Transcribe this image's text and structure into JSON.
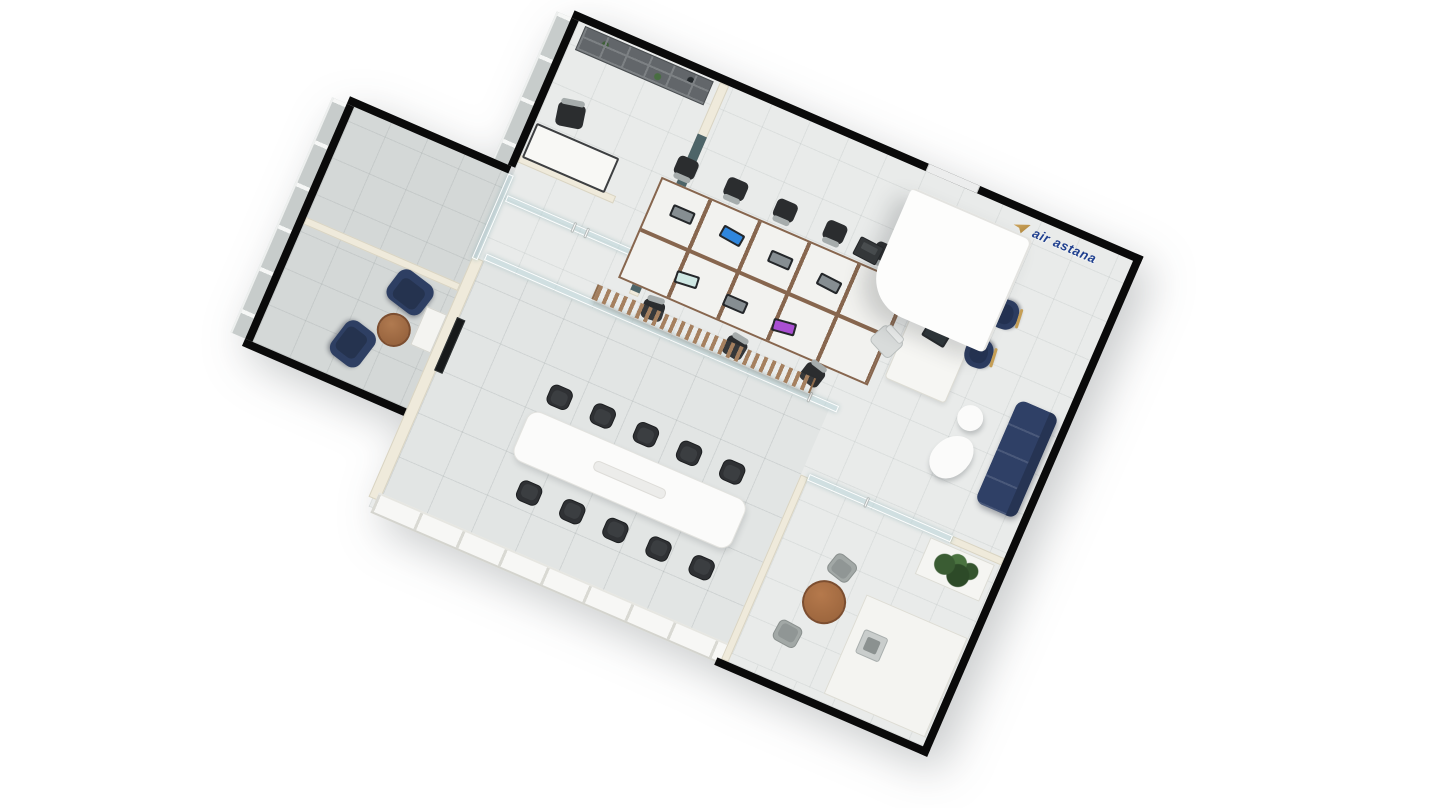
{
  "logo": {
    "text": "air astana",
    "icon": "air-astana-bird-icon",
    "text_color": "#20408f",
    "icon_gold": "#c59e55"
  },
  "palette": {
    "wall_black": "#0a0a0a",
    "wall_cream": "#efeadb",
    "floor_main": "#e9ebea",
    "floor_wing": "#d4d8d7",
    "floor_meeting": "#e2e5e4",
    "glass": "#bcd6d9",
    "glass_dark": "#41595f",
    "navy_upholstery": "#2e3f63",
    "wood_slats": "#a5805f",
    "walnut": "#a06a44",
    "gold": "#c59e55",
    "screen_blue": "#2f86dd",
    "screen_purple": "#a94fd2"
  },
  "rooms": [
    {
      "name": "executive-office"
    },
    {
      "name": "glass-meeting-booth"
    },
    {
      "name": "lounge"
    },
    {
      "name": "conference-room"
    },
    {
      "name": "open-workspace"
    },
    {
      "name": "reception"
    },
    {
      "name": "waiting-area"
    },
    {
      "name": "break-room"
    }
  ],
  "scene": {
    "floors": [
      {
        "t": "fla",
        "n": "floor-main",
        "x": 208,
        "y": 8,
        "w": 604,
        "h": 529
      },
      {
        "t": "flb",
        "n": "floor-left-wing",
        "x": 36,
        "y": 176,
        "w": 168,
        "h": 256
      },
      {
        "t": "flc",
        "n": "floor-conference-room",
        "x": 216,
        "y": 266,
        "w": 376,
        "h": 262
      },
      {
        "t": "fla",
        "n": "floor-break-room",
        "x": 600,
        "y": 340,
        "w": 212,
        "h": 188
      }
    ],
    "windows": [
      {
        "t": "wbv",
        "n": "window-band",
        "x": 184,
        "y": 8,
        "w": 16,
        "h": 160
      },
      {
        "t": "wbv",
        "n": "window-band",
        "x": 12,
        "y": 176,
        "w": 16,
        "h": 256
      }
    ],
    "walls": [
      {
        "t": "wk",
        "n": "exterior-wall-top",
        "x": 200,
        "y": 0,
        "w": 620,
        "h": 8
      },
      {
        "t": "wk",
        "n": "exterior-wall-right",
        "x": 812,
        "y": 0,
        "w": 8,
        "h": 545
      },
      {
        "t": "wk",
        "n": "exterior-wall-bottom",
        "x": 588,
        "y": 537,
        "w": 232,
        "h": 8
      },
      {
        "t": "wk",
        "n": "exterior-wall-left",
        "x": 200,
        "y": 8,
        "w": 8,
        "h": 160
      },
      {
        "t": "wk",
        "n": "wing-wall-top",
        "x": 28,
        "y": 168,
        "w": 176,
        "h": 8
      },
      {
        "t": "wk",
        "n": "wing-wall-left",
        "x": 28,
        "y": 176,
        "w": 8,
        "h": 256
      },
      {
        "t": "wk",
        "n": "wing-wall-bottom",
        "x": 28,
        "y": 432,
        "w": 176,
        "h": 8
      },
      {
        "t": "gap",
        "n": "entrance-door",
        "x": 586,
        "y": 0,
        "w": 56,
        "h": 8
      },
      {
        "t": "wc",
        "n": "interior-wall",
        "x": 208,
        "y": 154,
        "w": 104,
        "h": 8
      },
      {
        "t": "wc",
        "n": "interior-wall",
        "x": 352,
        "y": 154,
        "w": 16,
        "h": 8
      },
      {
        "t": "wc",
        "n": "interior-wall",
        "x": 362,
        "y": 8,
        "w": 10,
        "h": 230
      },
      {
        "t": "wc",
        "n": "conference-left-wall",
        "x": 204,
        "y": 266,
        "w": 12,
        "h": 262
      },
      {
        "t": "wc",
        "n": "break-room-wall",
        "x": 592,
        "y": 336,
        "w": 8,
        "h": 201
      },
      {
        "t": "wc",
        "n": "break-room-wall",
        "x": 756,
        "y": 332,
        "w": 56,
        "h": 8
      },
      {
        "t": "wc",
        "n": "wing-divider-wall",
        "x": 36,
        "y": 296,
        "w": 168,
        "h": 8
      },
      {
        "t": "wglz",
        "n": "glazed-curtain-wall",
        "x": 212,
        "y": 520,
        "w": 380,
        "h": 22
      }
    ],
    "glass": [
      {
        "t": "wg",
        "n": "glass-partition",
        "x": 216,
        "y": 258,
        "w": 384,
        "h": 7
      },
      {
        "t": "wg",
        "n": "glass-partition",
        "x": 204,
        "y": 176,
        "w": 6,
        "h": 92
      },
      {
        "t": "wg",
        "n": "glass-door",
        "x": 212,
        "y": 196,
        "w": 150,
        "h": 7
      },
      {
        "t": "wg",
        "n": "glass-door",
        "x": 600,
        "y": 332,
        "w": 156,
        "h": 7
      },
      {
        "t": "wgd",
        "n": "dark-glass-panel",
        "x": 362,
        "y": 64,
        "w": 10,
        "h": 170
      },
      {
        "t": "handle",
        "n": "door-handle",
        "x": 284,
        "y": 194,
        "w": 3,
        "h": 11
      },
      {
        "t": "handle",
        "n": "door-handle",
        "x": 298,
        "y": 194,
        "w": 3,
        "h": 11
      },
      {
        "t": "handle",
        "n": "door-handle",
        "x": 568,
        "y": 256,
        "w": 3,
        "h": 11
      },
      {
        "t": "handle",
        "n": "door-handle",
        "x": 662,
        "y": 330,
        "w": 3,
        "h": 11
      }
    ],
    "furniture": [
      {
        "t": "bookshelf",
        "n": "bookshelf",
        "x": 216,
        "y": 10,
        "w": 140,
        "h": 26
      },
      {
        "t": "desk",
        "n": "executive-desk",
        "x": 210,
        "y": 118,
        "w": 90,
        "h": 38
      },
      {
        "t": "chd",
        "n": "executive-chair",
        "x": 224,
        "y": 86,
        "w": 28,
        "h": 24,
        "r": -12
      },
      {
        "t": "armchair",
        "n": "lounge-armchair",
        "x": 140,
        "y": 306,
        "w": 42,
        "h": 36,
        "r": 14
      },
      {
        "t": "armchair",
        "n": "lounge-armchair",
        "x": 108,
        "y": 376,
        "w": 42,
        "h": 36,
        "r": 104
      },
      {
        "t": "ctable",
        "n": "coffee-table",
        "x": 144,
        "y": 348,
        "w": 34,
        "h": 34
      },
      {
        "t": "cabinet",
        "n": "side-cabinet",
        "x": 182,
        "y": 330,
        "w": 22,
        "h": 42
      },
      {
        "t": "tv",
        "n": "wall-tv",
        "x": 214,
        "y": 328,
        "w": 9,
        "h": 58
      },
      {
        "t": "conf",
        "n": "conference-table",
        "x": 318,
        "y": 382,
        "w": 238,
        "h": 54
      },
      {
        "t": "mchair",
        "n": "conference-chair",
        "x": 328,
        "y": 350,
        "w": 24,
        "h": 22
      },
      {
        "t": "mchair",
        "n": "conference-chair",
        "x": 375,
        "y": 350,
        "w": 24,
        "h": 22
      },
      {
        "t": "mchair",
        "n": "conference-chair",
        "x": 422,
        "y": 350,
        "w": 24,
        "h": 22
      },
      {
        "t": "mchair",
        "n": "conference-chair",
        "x": 469,
        "y": 350,
        "w": 24,
        "h": 22
      },
      {
        "t": "mchair",
        "n": "conference-chair",
        "x": 516,
        "y": 350,
        "w": 24,
        "h": 22
      },
      {
        "t": "mchair",
        "n": "conference-chair",
        "x": 338,
        "y": 450,
        "w": 24,
        "h": 22,
        "r": 180
      },
      {
        "t": "mchair",
        "n": "conference-chair",
        "x": 385,
        "y": 450,
        "w": 24,
        "h": 22,
        "r": 180
      },
      {
        "t": "mchair",
        "n": "conference-chair",
        "x": 432,
        "y": 450,
        "w": 24,
        "h": 22,
        "r": 180
      },
      {
        "t": "mchair",
        "n": "conference-chair",
        "x": 479,
        "y": 450,
        "w": 24,
        "h": 22,
        "r": 180
      },
      {
        "t": "mchair",
        "n": "conference-chair",
        "x": 526,
        "y": 450,
        "w": 24,
        "h": 22,
        "r": 180
      },
      {
        "t": "deskblock",
        "n": "workstation-desks",
        "x": 346,
        "y": 118,
        "w": 272,
        "h": 110
      },
      {
        "t": "slats",
        "n": "wood-slat-screen",
        "x": 330,
        "y": 242,
        "w": 238,
        "h": 16
      },
      {
        "t": "monitor",
        "n": "desktop-monitor",
        "x": 368,
        "y": 138,
        "w": 24,
        "h": 13,
        "v": "#868e92"
      },
      {
        "t": "monitor",
        "n": "desktop-monitor",
        "x": 422,
        "y": 138,
        "w": 24,
        "h": 13,
        "v": "#2f86dd",
        "r": 6
      },
      {
        "t": "monitor",
        "n": "desktop-monitor",
        "x": 476,
        "y": 141,
        "w": 24,
        "h": 13,
        "v": "#868e92"
      },
      {
        "t": "monitor",
        "n": "desktop-monitor",
        "x": 530,
        "y": 143,
        "w": 24,
        "h": 13,
        "v": "#868e92",
        "r": 4
      },
      {
        "t": "monitor",
        "n": "desktop-monitor",
        "x": 398,
        "y": 196,
        "w": 24,
        "h": 13,
        "v": "#cfe8e4",
        "r": -6
      },
      {
        "t": "monitor",
        "n": "desktop-monitor",
        "x": 452,
        "y": 199,
        "w": 24,
        "h": 13,
        "v": "#868e92"
      },
      {
        "t": "monitor",
        "n": "desktop-monitor",
        "x": 506,
        "y": 201,
        "w": 24,
        "h": 13,
        "v": "#a94fd2",
        "r": -8
      },
      {
        "t": "chd",
        "n": "task-chair",
        "x": 354,
        "y": 90,
        "w": 22,
        "h": 20,
        "r": 180
      },
      {
        "t": "chd",
        "n": "task-chair",
        "x": 408,
        "y": 90,
        "w": 22,
        "h": 20,
        "r": 180
      },
      {
        "t": "chd",
        "n": "task-chair",
        "x": 462,
        "y": 90,
        "w": 22,
        "h": 20,
        "r": 180
      },
      {
        "t": "chd",
        "n": "task-chair",
        "x": 516,
        "y": 90,
        "w": 22,
        "h": 20,
        "r": 180
      },
      {
        "t": "chd",
        "n": "task-chair",
        "x": 570,
        "y": 90,
        "w": 22,
        "h": 20,
        "r": 180
      },
      {
        "t": "chd",
        "n": "task-chair",
        "x": 380,
        "y": 234,
        "w": 22,
        "h": 20,
        "r": -6
      },
      {
        "t": "chd",
        "n": "task-chair",
        "x": 470,
        "y": 236,
        "w": 22,
        "h": 20,
        "r": 8
      },
      {
        "t": "chd",
        "n": "task-chair",
        "x": 552,
        "y": 230,
        "w": 22,
        "h": 20,
        "r": 14
      },
      {
        "t": "counter",
        "n": "reception-counter",
        "x": 630,
        "y": 62,
        "w": 66,
        "h": 152
      },
      {
        "t": "monitor",
        "n": "counter-monitor",
        "x": 654,
        "y": 84,
        "w": 26,
        "h": 20,
        "v": "#2d3438",
        "r": 8
      },
      {
        "t": "monitor",
        "n": "counter-monitor",
        "x": 648,
        "y": 142,
        "w": 26,
        "h": 20,
        "v": "#2d3438",
        "r": 8
      },
      {
        "t": "chl",
        "n": "staff-chair",
        "x": 604,
        "y": 168,
        "w": 28,
        "h": 24,
        "r": 24
      },
      {
        "t": "printer",
        "n": "printer",
        "x": 552,
        "y": 94,
        "w": 26,
        "h": 20,
        "r": 4
      },
      {
        "t": "gnavy",
        "n": "guest-chair",
        "x": 700,
        "y": 94,
        "w": 30,
        "h": 28,
        "r": -96
      },
      {
        "t": "gnavy",
        "n": "guest-chair",
        "x": 692,
        "y": 140,
        "w": 30,
        "h": 28,
        "r": -96
      },
      {
        "t": "sofa",
        "n": "waiting-sofa",
        "x": 762,
        "y": 180,
        "w": 44,
        "h": 112
      },
      {
        "t": "dot",
        "n": "info-sculpture-dot",
        "x": 712,
        "y": 204,
        "w": 26,
        "h": 26
      },
      {
        "t": "blob",
        "n": "info-sculpture-body",
        "x": 704,
        "y": 236,
        "w": 38,
        "h": 48,
        "r": 10
      },
      {
        "t": "rtable",
        "n": "break-table",
        "x": 642,
        "y": 422,
        "w": 44,
        "h": 44
      },
      {
        "t": "gchair",
        "n": "break-chair",
        "x": 654,
        "y": 394,
        "w": 26,
        "h": 23,
        "r": 15
      },
      {
        "t": "gchair",
        "n": "break-chair",
        "x": 630,
        "y": 476,
        "w": 26,
        "h": 23,
        "r": 185
      },
      {
        "t": "planter",
        "n": "planter-box",
        "x": 736,
        "y": 342,
        "w": 70,
        "h": 40
      },
      {
        "t": "plant",
        "n": "potted-plant",
        "x": 744,
        "y": 346,
        "w": 52,
        "h": 34
      },
      {
        "t": "kcounter",
        "n": "kitchen-counter",
        "x": 700,
        "y": 420,
        "w": 110,
        "h": 108
      },
      {
        "t": "sink",
        "n": "sink",
        "x": 712,
        "y": 452,
        "w": 26,
        "h": 26
      }
    ]
  }
}
